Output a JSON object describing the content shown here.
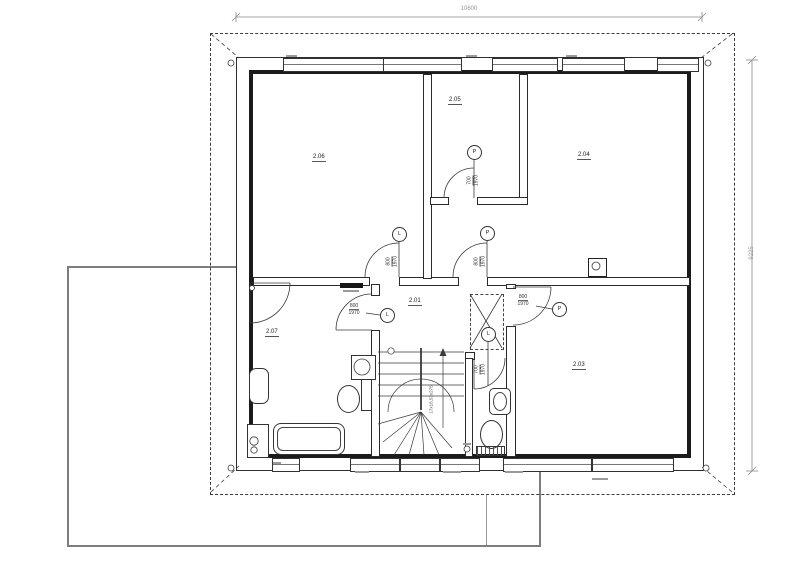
{
  "dimensions": {
    "width": "10600",
    "height": "9225"
  },
  "rooms": {
    "r201": "2.01",
    "r203": "2.03",
    "r204": "2.04",
    "r205": "2.05",
    "r206": "2.06",
    "r207": "2.07"
  },
  "doors": {
    "to_r206": {
      "w": "800",
      "h": "1970",
      "swing": "L"
    },
    "to_r204": {
      "w": "800",
      "h": "1970",
      "swing": "P"
    },
    "to_r205": {
      "w": "700",
      "h": "1970",
      "swing": "P"
    },
    "to_r203": {
      "w": "800",
      "h": "1970",
      "swing": "P"
    },
    "to_r207": {
      "w": "800",
      "h": "1970",
      "swing": "L"
    },
    "to_wc": {
      "w": "700",
      "h": "1970",
      "swing": "L"
    }
  },
  "stairs": {
    "annotation": "17x18,53x275"
  },
  "colors": {
    "line": "#2b2b2b",
    "gray": "#9a9a9a",
    "terrace": "#7d7d7d"
  }
}
